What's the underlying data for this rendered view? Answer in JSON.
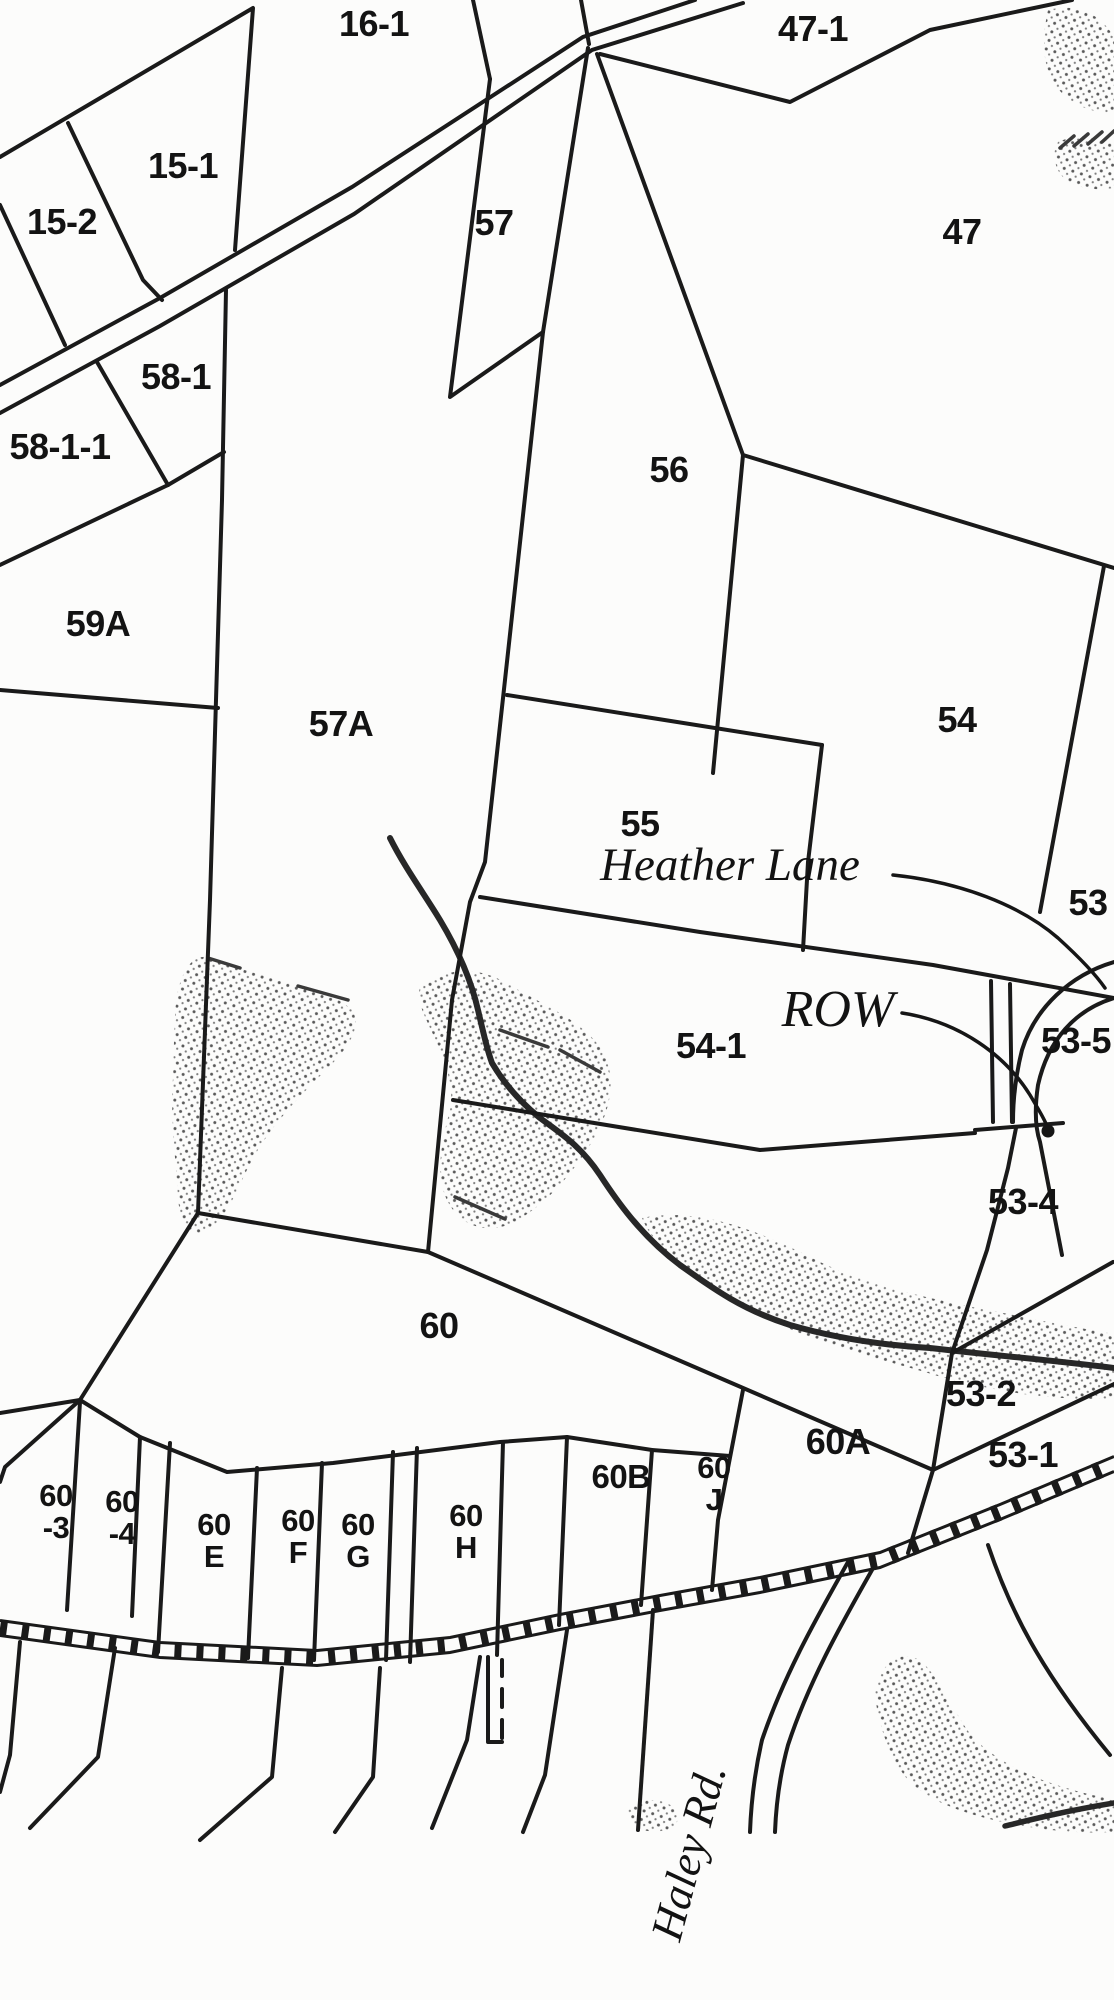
{
  "map": {
    "title": "Tax parcel map section",
    "colors": {
      "ink": "#1a1a1a",
      "paper": "#fcfcfb",
      "stipple_dot": "#5a5a5a"
    },
    "parcel_labels": [
      {
        "id": "16-1",
        "lines": [
          "16-1"
        ],
        "x": 374,
        "y": 36,
        "size": 36
      },
      {
        "id": "47-1",
        "lines": [
          "47-1"
        ],
        "x": 813,
        "y": 41,
        "size": 36
      },
      {
        "id": "15-1",
        "lines": [
          "15-1"
        ],
        "x": 183,
        "y": 178,
        "size": 36
      },
      {
        "id": "15-2",
        "lines": [
          "15-2"
        ],
        "x": 62,
        "y": 234,
        "size": 36
      },
      {
        "id": "57",
        "lines": [
          "57"
        ],
        "x": 494,
        "y": 235,
        "size": 36
      },
      {
        "id": "47",
        "lines": [
          "47"
        ],
        "x": 962,
        "y": 244,
        "size": 36
      },
      {
        "id": "58-1",
        "lines": [
          "58-1"
        ],
        "x": 176,
        "y": 389,
        "size": 36
      },
      {
        "id": "58-1-1",
        "lines": [
          "58-1-1"
        ],
        "x": 60,
        "y": 459,
        "size": 36
      },
      {
        "id": "56",
        "lines": [
          "56"
        ],
        "x": 669,
        "y": 482,
        "size": 36
      },
      {
        "id": "59A",
        "lines": [
          "59A"
        ],
        "x": 98,
        "y": 636,
        "size": 36
      },
      {
        "id": "57A",
        "lines": [
          "57A"
        ],
        "x": 341,
        "y": 736,
        "size": 36
      },
      {
        "id": "54",
        "lines": [
          "54"
        ],
        "x": 957,
        "y": 732,
        "size": 36
      },
      {
        "id": "55",
        "lines": [
          "55"
        ],
        "x": 640,
        "y": 836,
        "size": 36
      },
      {
        "id": "53",
        "lines": [
          "53"
        ],
        "x": 1088,
        "y": 915,
        "size": 36
      },
      {
        "id": "54-1",
        "lines": [
          "54-1"
        ],
        "x": 711,
        "y": 1058,
        "size": 36
      },
      {
        "id": "53-5",
        "lines": [
          "53-5"
        ],
        "x": 1076,
        "y": 1053,
        "size": 36
      },
      {
        "id": "53-4",
        "lines": [
          "53-4"
        ],
        "x": 1023,
        "y": 1214,
        "size": 36
      },
      {
        "id": "60",
        "lines": [
          "60"
        ],
        "x": 439,
        "y": 1338,
        "size": 36
      },
      {
        "id": "53-2",
        "lines": [
          "53-2"
        ],
        "x": 981,
        "y": 1406,
        "size": 36
      },
      {
        "id": "60A",
        "lines": [
          "60A"
        ],
        "x": 838,
        "y": 1454,
        "size": 36
      },
      {
        "id": "53-1",
        "lines": [
          "53-1"
        ],
        "x": 1023,
        "y": 1467,
        "size": 36
      },
      {
        "id": "60B",
        "lines": [
          "60B"
        ],
        "x": 621,
        "y": 1488,
        "size": 33
      },
      {
        "id": "60J",
        "lines": [
          "60",
          "J"
        ],
        "x": 714,
        "y": 1478,
        "size": 31
      },
      {
        "id": "60-3",
        "lines": [
          "60",
          "-3"
        ],
        "x": 56,
        "y": 1506,
        "size": 31
      },
      {
        "id": "60-4",
        "lines": [
          "60",
          "-4"
        ],
        "x": 122,
        "y": 1512,
        "size": 31
      },
      {
        "id": "60E",
        "lines": [
          "60",
          "E"
        ],
        "x": 214,
        "y": 1535,
        "size": 31
      },
      {
        "id": "60F",
        "lines": [
          "60",
          "F"
        ],
        "x": 298,
        "y": 1531,
        "size": 31
      },
      {
        "id": "60G",
        "lines": [
          "60",
          "G"
        ],
        "x": 358,
        "y": 1535,
        "size": 31
      },
      {
        "id": "60H",
        "lines": [
          "60",
          "H"
        ],
        "x": 466,
        "y": 1526,
        "size": 31
      }
    ],
    "road_labels": [
      {
        "id": "heather-lane",
        "text": "Heather Lane",
        "x": 730,
        "y": 880,
        "size": 47,
        "rotate": 0
      },
      {
        "id": "row",
        "text": "ROW",
        "x": 838,
        "y": 1026,
        "size": 52,
        "rotate": 0
      },
      {
        "id": "haley-rd",
        "text": "Haley Rd.",
        "x": 703,
        "y": 1856,
        "size": 45,
        "rotate": -75
      }
    ]
  }
}
